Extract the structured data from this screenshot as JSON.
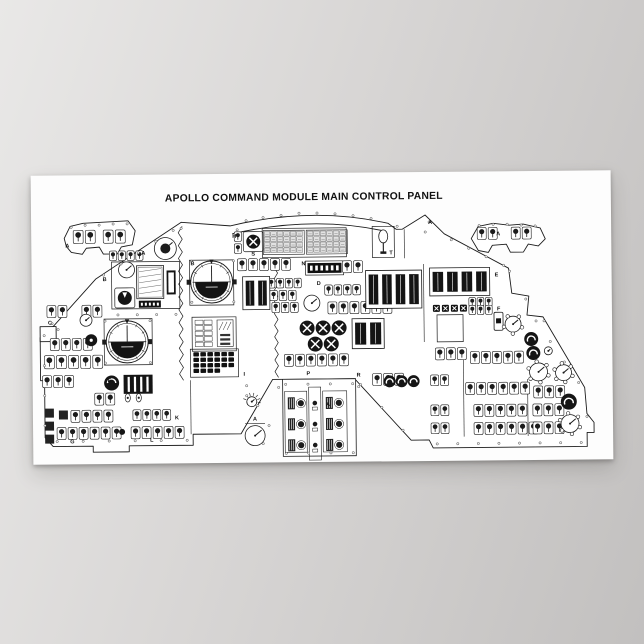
{
  "title": "APOLLO COMMAND MODULE MAIN CONTROL PANEL",
  "colors": {
    "background_left": "#e9e8e7",
    "background_mid": "#d8d6d5",
    "background_right": "#c2c0bf",
    "paper": "#fdfdfd",
    "ink": "#1c1c1c"
  },
  "panel": {
    "title_pos": {
      "x": 273,
      "y": 27,
      "size": 10.3
    },
    "labels": [
      {
        "t": "A",
        "x": 34,
        "y": 72
      },
      {
        "t": "A",
        "x": 110,
        "y": 80
      },
      {
        "t": "B",
        "x": 159,
        "y": 91
      },
      {
        "t": "B",
        "x": 71,
        "y": 106
      },
      {
        "t": "C",
        "x": 16,
        "y": 149
      },
      {
        "t": "H",
        "x": 201,
        "y": 64
      },
      {
        "t": "S",
        "x": 220,
        "y": 82
      },
      {
        "t": "N",
        "x": 270,
        "y": 92
      },
      {
        "t": "T",
        "x": 358,
        "y": 82
      },
      {
        "t": "A",
        "x": 397,
        "y": 52
      },
      {
        "t": "D",
        "x": 285,
        "y": 112
      },
      {
        "t": "E",
        "x": 463,
        "y": 105
      },
      {
        "t": "F",
        "x": 465,
        "y": 139
      },
      {
        "t": "A",
        "x": 465,
        "y": 64
      },
      {
        "t": "I",
        "x": 211,
        "y": 202
      },
      {
        "t": "P",
        "x": 274,
        "y": 202
      },
      {
        "t": "R",
        "x": 324,
        "y": 204
      },
      {
        "t": "A",
        "x": 293,
        "y": 233
      },
      {
        "t": "A",
        "x": 220,
        "y": 247
      },
      {
        "t": "E",
        "x": 75,
        "y": 207
      },
      {
        "t": "K",
        "x": 142,
        "y": 245
      },
      {
        "t": "L",
        "x": 117,
        "y": 267
      },
      {
        "t": "G",
        "x": 37,
        "y": 268
      }
    ],
    "outlines": [
      {
        "n": "main-panel",
        "d": "M150 48 L199 52 Q282 33 357 51 L365 57 L371 57 L394 43 L413 62 L477 97 L480 122 L497 125 L495 144 L511 146 L552 217 L554 243 L561 252 L561 262 L554 262 L554 276 L400 276 L396 268 L378 268 L322 206 L240 206 L208 260 L160 260 L160 271 L96 271 L96 277 L60 277 L60 271 L20 271 L12 262 L12 205 L8 205 L8 162 L22 150 L64 104 Z"
      },
      {
        "n": "left-wing",
        "d": "M33 63 L39 51 L52 48 L97 46 L104 56 L101 70 L90 72 L86 79 L72 79 L68 72 L55 73 L51 79 L40 77 L35 71 Z"
      },
      {
        "n": "right-wing",
        "d": "M440 67 L447 55 L462 52 L478 54 L492 53 L509 57 L514 68 L507 75 L497 73 L492 81 L479 81 L475 73 L461 74 L457 81 L447 79 Z"
      },
      {
        "n": "arc-inner",
        "d": "M201 60 Q282 42 355 59",
        "open": true
      },
      {
        "n": "side-box",
        "d": "M8 151 h16 v15 h-16 Z"
      }
    ],
    "scallops": [
      {
        "x": 151,
        "y1": 52,
        "y2": 206,
        "amp": 4,
        "n": 12
      },
      {
        "x": 246,
        "y1": 88,
        "y2": 204,
        "amp": 3.5,
        "n": 10
      }
    ],
    "vlines": [
      {
        "x1": 373,
        "y1": 57,
        "x2": 373,
        "y2": 86
      },
      {
        "x1": 392,
        "y1": 92,
        "x2": 392,
        "y2": 170
      },
      {
        "x1": 158,
        "y1": 206,
        "x2": 158,
        "y2": 260
      },
      {
        "x1": 431,
        "y1": 178,
        "x2": 431,
        "y2": 265
      },
      {
        "x1": 495,
        "y1": 208,
        "x2": 495,
        "y2": 265
      },
      {
        "x1": 212,
        "y1": 250,
        "x2": 232,
        "y2": 250
      }
    ],
    "frames": [
      {
        "x": 80,
        "y": 87,
        "w": 68,
        "h": 47
      },
      {
        "x": 158,
        "y": 86,
        "w": 44,
        "h": 45
      },
      {
        "x": 72,
        "y": 144,
        "w": 48,
        "h": 46
      },
      {
        "x": 160,
        "y": 143,
        "w": 44,
        "h": 34
      },
      {
        "x": 158,
        "y": 175,
        "w": 48,
        "h": 28
      },
      {
        "x": 231,
        "y": 55,
        "w": 84,
        "h": 29
      },
      {
        "x": 341,
        "y": 54,
        "w": 22,
        "h": 31
      },
      {
        "x": 274,
        "y": 88,
        "w": 38,
        "h": 14
      },
      {
        "x": 405,
        "y": 143,
        "w": 26,
        "h": 27
      }
    ],
    "fdais": [
      {
        "x": 180,
        "y": 108,
        "r": 21
      },
      {
        "x": 95,
        "y": 167,
        "r": 21
      }
    ],
    "tapebanks": [
      {
        "x": 334,
        "y": 98,
        "w": 56,
        "h": 38,
        "n": 4
      },
      {
        "x": 398,
        "y": 96,
        "w": 60,
        "h": 28,
        "n": 4
      },
      {
        "x": 211,
        "y": 103,
        "w": 27,
        "h": 33,
        "n": 2
      },
      {
        "x": 320,
        "y": 146,
        "w": 32,
        "h": 30,
        "n": 2
      }
    ],
    "lightgrids": [
      {
        "x": 233,
        "y": 58,
        "cols": 6,
        "rows": 4,
        "cw": 6.5,
        "ch": 5.5
      },
      {
        "x": 276,
        "y": 58,
        "cols": 6,
        "rows": 4,
        "cw": 6.5,
        "ch": 5.5
      }
    ],
    "matrices": [
      {
        "x": 161,
        "y": 178,
        "cw": 7,
        "ch": 5.5,
        "rows": [
          6,
          6,
          6,
          4
        ]
      }
    ],
    "ems": {
      "x": 105,
      "y": 91,
      "w": 27,
      "h": 33,
      "readout": {
        "x": 107,
        "y": 126,
        "w": 22,
        "h": 7
      }
    },
    "timer": {
      "x": 276,
      "y": 90,
      "w": 34,
      "h": 10,
      "digits": 6
    },
    "statuscol": {
      "x": 163,
      "y": 146,
      "cw": 9,
      "ch": 5.5,
      "cols": 2,
      "rows": 5,
      "pct_x": 185
    },
    "stripeboxes": [
      {
        "x": 91,
        "y": 200,
        "w": 29,
        "h": 19,
        "n": 4
      },
      {
        "x": 135,
        "y": 96,
        "w": 9,
        "h": 24,
        "n": 3
      }
    ],
    "thandle": {
      "x": 343,
      "y": 56,
      "w": 18,
      "h": 27
    },
    "xrow": {
      "x": 401,
      "y": 133,
      "n": 4,
      "cell": 7
    },
    "fbox": {
      "x": 462,
      "y": 141,
      "w": 9,
      "h": 18
    },
    "squares": [
      {
        "x": 12,
        "y": 233,
        "n": 3,
        "size": 9,
        "gap": 13
      },
      {
        "x": 26,
        "y": 235,
        "n": 1,
        "size": 9,
        "gap": 0
      }
    ],
    "ovals": [
      {
        "x": 95,
        "y": 223
      },
      {
        "x": 106,
        "y": 223
      }
    ],
    "breakers": {
      "x": 250,
      "y": 206,
      "w": 73,
      "h": 77
    },
    "pods": [
      {
        "x": 15,
        "y": 130,
        "n": 2
      },
      {
        "x": 50,
        "y": 130,
        "n": 2
      },
      {
        "x": 78,
        "y": 76,
        "n": 4,
        "s": 0.8
      },
      {
        "x": 18,
        "y": 163,
        "n": 4
      },
      {
        "x": 12,
        "y": 180,
        "n": 5,
        "s": 1.1
      },
      {
        "x": 10,
        "y": 200,
        "n": 3
      },
      {
        "x": 62,
        "y": 218,
        "n": 2
      },
      {
        "x": 38,
        "y": 235,
        "n": 4
      },
      {
        "x": 24,
        "y": 252,
        "n": 6
      },
      {
        "x": 100,
        "y": 235,
        "n": 4,
        "s": 0.9
      },
      {
        "x": 98,
        "y": 252,
        "n": 5
      },
      {
        "x": 203,
        "y": 58,
        "n": 1,
        "s": 0.8
      },
      {
        "x": 203,
        "y": 70,
        "n": 1,
        "s": 0.8
      },
      {
        "x": 206,
        "y": 85,
        "n": 5
      },
      {
        "x": 311,
        "y": 88,
        "n": 2
      },
      {
        "x": 236,
        "y": 105,
        "n": 4,
        "s": 0.8
      },
      {
        "x": 238,
        "y": 117,
        "n": 3,
        "s": 0.85
      },
      {
        "x": 240,
        "y": 129,
        "n": 3,
        "s": 0.85
      },
      {
        "x": 293,
        "y": 112,
        "n": 4,
        "s": 0.85
      },
      {
        "x": 296,
        "y": 129,
        "n": 6
      },
      {
        "x": 252,
        "y": 181,
        "n": 6
      },
      {
        "x": 403,
        "y": 176,
        "n": 3
      },
      {
        "x": 438,
        "y": 180,
        "n": 5
      },
      {
        "x": 398,
        "y": 203,
        "n": 2,
        "s": 0.9
      },
      {
        "x": 433,
        "y": 211,
        "n": 6
      },
      {
        "x": 501,
        "y": 215,
        "n": 3
      },
      {
        "x": 441,
        "y": 233,
        "n": 5
      },
      {
        "x": 500,
        "y": 233,
        "n": 3
      },
      {
        "x": 441,
        "y": 251,
        "n": 6
      },
      {
        "x": 500,
        "y": 251,
        "n": 3
      },
      {
        "x": 398,
        "y": 233,
        "n": 2,
        "s": 0.9
      },
      {
        "x": 398,
        "y": 251,
        "n": 2,
        "s": 0.9
      },
      {
        "x": 340,
        "y": 201,
        "n": 3
      },
      {
        "x": 437,
        "y": 126,
        "n": 3,
        "s": 0.75
      },
      {
        "x": 437,
        "y": 134,
        "n": 3,
        "s": 0.75
      },
      {
        "x": 42,
        "y": 55,
        "n": 2,
        "s": 1.1
      },
      {
        "x": 72,
        "y": 55,
        "n": 2,
        "s": 1.1
      },
      {
        "x": 446,
        "y": 56,
        "n": 2
      },
      {
        "x": 480,
        "y": 56,
        "n": 2
      }
    ],
    "knobs": [
      {
        "x": 222,
        "y": 68,
        "r": 7,
        "g": "X",
        "sq": 1
      },
      {
        "x": 275,
        "y": 155,
        "r": 7.5,
        "g": "X"
      },
      {
        "x": 291,
        "y": 155,
        "r": 7.5,
        "g": "X"
      },
      {
        "x": 307,
        "y": 155,
        "r": 7.5,
        "g": "X"
      },
      {
        "x": 283,
        "y": 171,
        "r": 7.5,
        "g": "X"
      },
      {
        "x": 299,
        "y": 171,
        "r": 7.5,
        "g": "X"
      },
      {
        "x": 93,
        "y": 123,
        "r": 7,
        "g": "wedge",
        "sq": 1
      },
      {
        "x": 59,
        "y": 165,
        "r": 6,
        "g": "dot"
      },
      {
        "x": 79,
        "y": 208,
        "r": 7.5,
        "g": "arc"
      },
      {
        "x": 89,
        "y": 257,
        "r": 3,
        "g": ""
      },
      {
        "x": 357,
        "y": 209,
        "r": 6,
        "g": "swirl"
      },
      {
        "x": 369,
        "y": 209,
        "r": 6,
        "g": "swirl"
      },
      {
        "x": 381,
        "y": 209,
        "r": 6,
        "g": "swirl"
      },
      {
        "x": 499,
        "y": 168,
        "r": 7,
        "g": "swirl"
      },
      {
        "x": 501,
        "y": 182,
        "r": 7,
        "g": "swirl"
      },
      {
        "x": 536,
        "y": 231,
        "r": 8,
        "g": "swirl"
      }
    ],
    "dials": [
      {
        "x": 95,
        "y": 95,
        "r": 8
      },
      {
        "x": 280,
        "y": 130,
        "r": 8
      },
      {
        "x": 134,
        "y": 74,
        "r": 11,
        "inner": 5
      },
      {
        "x": 54,
        "y": 145,
        "r": 6
      },
      {
        "x": 222,
        "y": 262,
        "r": 10
      },
      {
        "x": 219,
        "y": 228,
        "r": 5,
        "ticks": 1
      },
      {
        "x": 481,
        "y": 153,
        "r": 8,
        "petals": 5
      },
      {
        "x": 506,
        "y": 201,
        "r": 9,
        "petals": 6
      },
      {
        "x": 531,
        "y": 202,
        "r": 8,
        "petals": 6
      },
      {
        "x": 537,
        "y": 253,
        "r": 9,
        "petals": 6
      },
      {
        "x": 516,
        "y": 180,
        "r": 4
      }
    ],
    "screwlines": [
      {
        "x1": 72,
        "y1": 100,
        "x2": 142,
        "y2": 56,
        "n": 5
      },
      {
        "x1": 12,
        "y1": 160,
        "x2": 12,
        "y2": 250,
        "n": 4
      },
      {
        "x1": 24,
        "y1": 266,
        "x2": 154,
        "y2": 266,
        "n": 6
      },
      {
        "x1": 404,
        "y1": 272,
        "x2": 548,
        "y2": 272,
        "n": 8
      },
      {
        "x1": 420,
        "y1": 68,
        "x2": 472,
        "y2": 94,
        "n": 4
      },
      {
        "x1": 504,
        "y1": 150,
        "x2": 546,
        "y2": 212,
        "n": 4
      },
      {
        "x1": 214,
        "y1": 212,
        "x2": 236,
        "y2": 252,
        "n": 3
      },
      {
        "x1": 328,
        "y1": 212,
        "x2": 370,
        "y2": 258,
        "n": 3
      },
      {
        "x1": 86,
        "y1": 140,
        "x2": 144,
        "y2": 140,
        "n": 4
      },
      {
        "x1": 253,
        "y1": 211,
        "x2": 320,
        "y2": 211,
        "n": 4
      },
      {
        "x1": 253,
        "y1": 280,
        "x2": 320,
        "y2": 280,
        "n": 4
      }
    ],
    "screws": [
      [
        215,
        47
      ],
      [
        232,
        44
      ],
      [
        250,
        42
      ],
      [
        268,
        40
      ],
      [
        286,
        40
      ],
      [
        304,
        41
      ],
      [
        322,
        43
      ],
      [
        340,
        46
      ],
      [
        40,
        52
      ],
      [
        54,
        50
      ],
      [
        68,
        50
      ],
      [
        82,
        49
      ],
      [
        96,
        49
      ],
      [
        448,
        54
      ],
      [
        462,
        53
      ],
      [
        476,
        53
      ],
      [
        490,
        54
      ],
      [
        504,
        55
      ],
      [
        160,
        87
      ],
      [
        202,
        87
      ],
      [
        160,
        128
      ],
      [
        202,
        128
      ],
      [
        73,
        146
      ],
      [
        118,
        146
      ],
      [
        73,
        188
      ],
      [
        118,
        188
      ],
      [
        398,
        50
      ],
      [
        366,
        54
      ],
      [
        206,
        56
      ],
      [
        26,
        154
      ],
      [
        214,
        222
      ],
      [
        230,
        270
      ],
      [
        246,
        214
      ],
      [
        326,
        214
      ],
      [
        394,
        60
      ],
      [
        478,
        100
      ],
      [
        494,
        128
      ],
      [
        512,
        150
      ],
      [
        554,
        246
      ],
      [
        20,
        148
      ],
      [
        150,
        54
      ]
    ]
  }
}
